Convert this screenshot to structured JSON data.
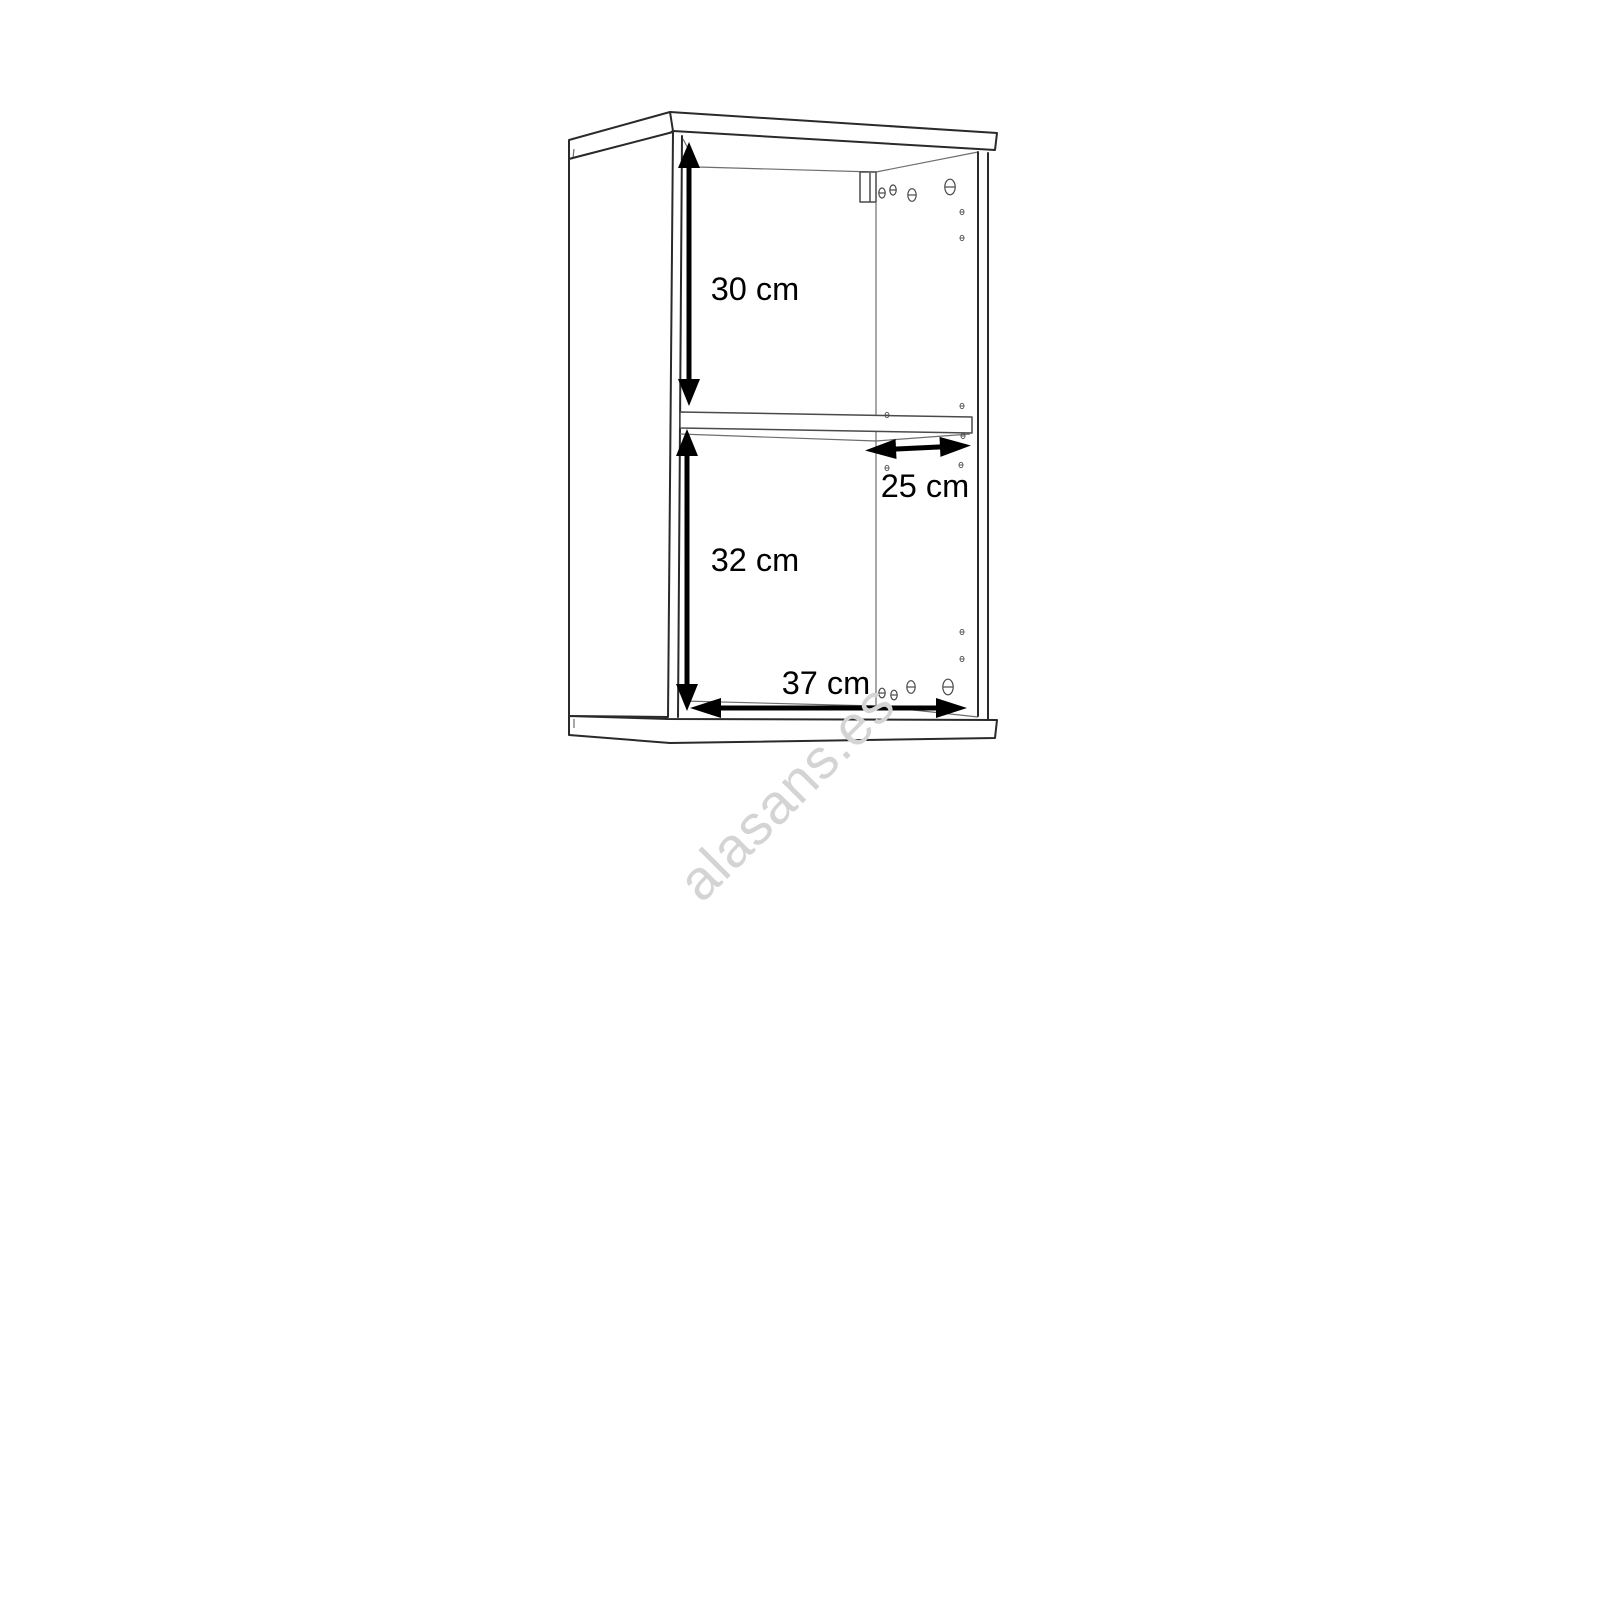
{
  "diagram": {
    "kind": "furniture dimension drawing",
    "subject": "open wall cabinet with two compartments, one middle shelf, wall-mount bracket and shelf-pin holes",
    "dimensions": {
      "top_compartment_height": {
        "label": "30 cm",
        "value": 30,
        "unit": "cm",
        "orientation": "vertical"
      },
      "bottom_compartment_height": {
        "label": "32 cm",
        "value": 32,
        "unit": "cm",
        "orientation": "vertical"
      },
      "shelf_depth": {
        "label": "25 cm",
        "value": 25,
        "unit": "cm",
        "orientation": "horizontal"
      },
      "interior_width": {
        "label": "37 cm",
        "value": 37,
        "unit": "cm",
        "orientation": "horizontal"
      }
    },
    "watermark": {
      "text": "alasans.es",
      "color": "#d4d4d4"
    },
    "colors": {
      "background": "#ffffff",
      "outline": "#2a2a2a",
      "thin_line": "#6e6e6e",
      "dimension": "#000000"
    }
  }
}
